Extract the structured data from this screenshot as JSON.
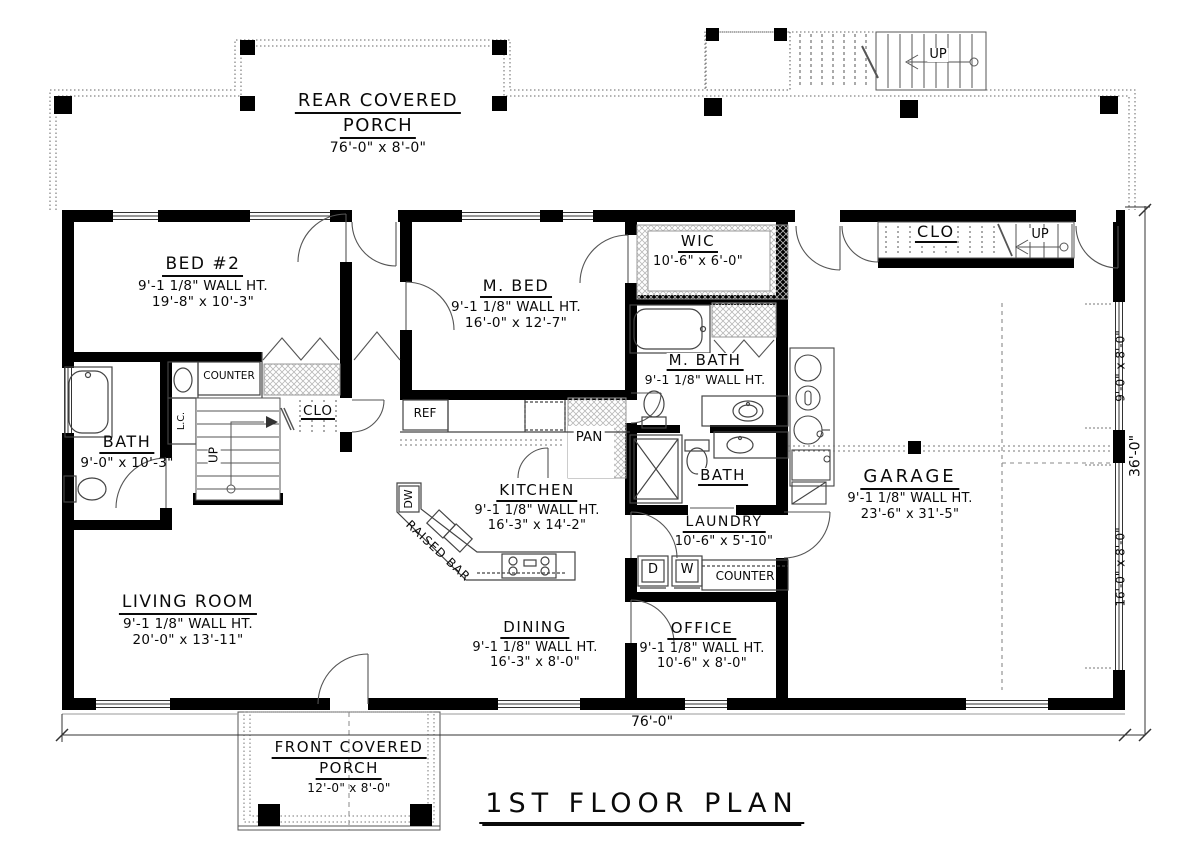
{
  "title": "1ST FLOOR PLAN",
  "dimensions": {
    "overall_width": "76'-0\"",
    "overall_depth": "36'-0\"",
    "garage_door_small": "9'-0\" x 8'-0\"",
    "garage_door_large": "16'-0\" x 8'-0\""
  },
  "rooms": {
    "rear_porch": {
      "name_line1": "REAR COVERED",
      "name_line2": "PORCH",
      "dims": "76'-0\" x 8'-0\""
    },
    "front_porch": {
      "name_line1": "FRONT COVERED",
      "name_line2": "PORCH",
      "dims": "12'-0\" x 8'-0\""
    },
    "bed2": {
      "name": "BED #2",
      "wall_ht": "9'-1 1/8\" WALL HT.",
      "dims": "19'-8\" x 10'-3\""
    },
    "master_bed": {
      "name": "M. BED",
      "wall_ht": "9'-1 1/8\" WALL HT.",
      "dims": "16'-0\" x 12'-7\""
    },
    "wic": {
      "name": "WIC",
      "dims": "10'-6\" x 6'-0\""
    },
    "master_bath": {
      "name": "M. BATH",
      "wall_ht": "9'-1 1/8\" WALL HT."
    },
    "bath": {
      "name": "BATH",
      "dims": "9'-0\" x 10'-3\""
    },
    "hall_bath": {
      "name": "BATH"
    },
    "kitchen": {
      "name": "KITCHEN",
      "wall_ht": "9'-1 1/8\" WALL HT.",
      "dims": "16'-3\" x 14'-2\""
    },
    "laundry": {
      "name": "LAUNDRY",
      "dims": "10'-6\" x 5'-10\""
    },
    "garage": {
      "name": "GARAGE",
      "wall_ht": "9'-1 1/8\" WALL HT.",
      "dims": "23'-6\" x 31'-5\""
    },
    "living": {
      "name": "LIVING ROOM",
      "wall_ht": "9'-1 1/8\" WALL HT.",
      "dims": "20'-0\" x 13'-11\""
    },
    "dining": {
      "name": "DINING",
      "wall_ht": "9'-1 1/8\" WALL HT.",
      "dims": "16'-3\" x 8'-0\""
    },
    "office": {
      "name": "OFFICE",
      "wall_ht": "9'-1 1/8\" WALL HT.",
      "dims": "10'-6\" x 8'-0\""
    }
  },
  "labels": {
    "ref": "REF",
    "pan": "PAN",
    "dw": "DW",
    "dryer": "D",
    "washer": "W",
    "counter_hall": "COUNTER",
    "counter_laundry": "COUNTER",
    "linen_closet": "L.C.",
    "closet_hall": "CLO",
    "closet_garage": "CLO",
    "up_porch_stairs": "UP",
    "up_center_stairs": "UP",
    "up_garage_stairs": "UP",
    "raised_bar": "RAISED BAR"
  },
  "colors": {
    "wall": "#000000",
    "line": "#444444",
    "hatch": "#b8b8b8",
    "background": "#ffffff"
  }
}
